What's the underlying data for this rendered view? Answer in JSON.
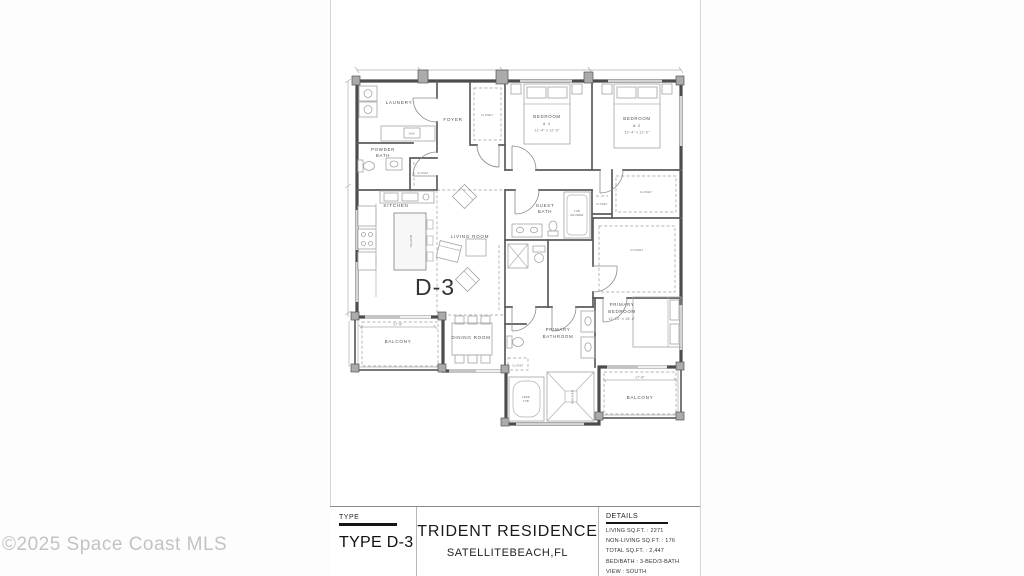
{
  "watermark": "©2025 Space Coast MLS",
  "sheet": {
    "title_block": {
      "type_label": "TYPE",
      "type_value": "TYPE D-3",
      "residence_name": "TRIDENT RESIDENCE",
      "residence_location": "SATELLITEBEACH,FL",
      "details_label": "DETAILS",
      "details": [
        "LIVING SQ.FT. : 2271",
        "NON-LIVING SQ.FT. : 176",
        "TOTAL SQ.FT. : 2,447",
        "BED/BATH : 3-BED/3-BATH",
        "VIEW : SOUTH"
      ]
    }
  },
  "floor_plan": {
    "unit_label": "D-3",
    "rooms": {
      "laundry": "LAUNDRY",
      "foyer": "FOYER",
      "powder": "POWDER",
      "bath": "BATH",
      "kitchen": "KITCHEN",
      "island": "ISLAND",
      "living_room": "LIVING ROOM",
      "bedroom": "BEDROOM",
      "bedroom1_num": "# 1",
      "bedroom2_num": "# 2",
      "bedroom_dim": "12'-4\" x 12'-0\"",
      "guest": "GUEST",
      "closet": "CLOSET",
      "dining_room": "DINING ROOM",
      "balcony": "BALCONY",
      "balcony_dim": "17'-8\"",
      "primary": "PRIMARY",
      "bathroom": "BATHROOM",
      "primary_bed_dim": "11'-10\" x 16'-6\"",
      "tub": "TUB",
      "shower": "SHOWER",
      "free": "FREE",
      "sink": "SINK"
    }
  }
}
